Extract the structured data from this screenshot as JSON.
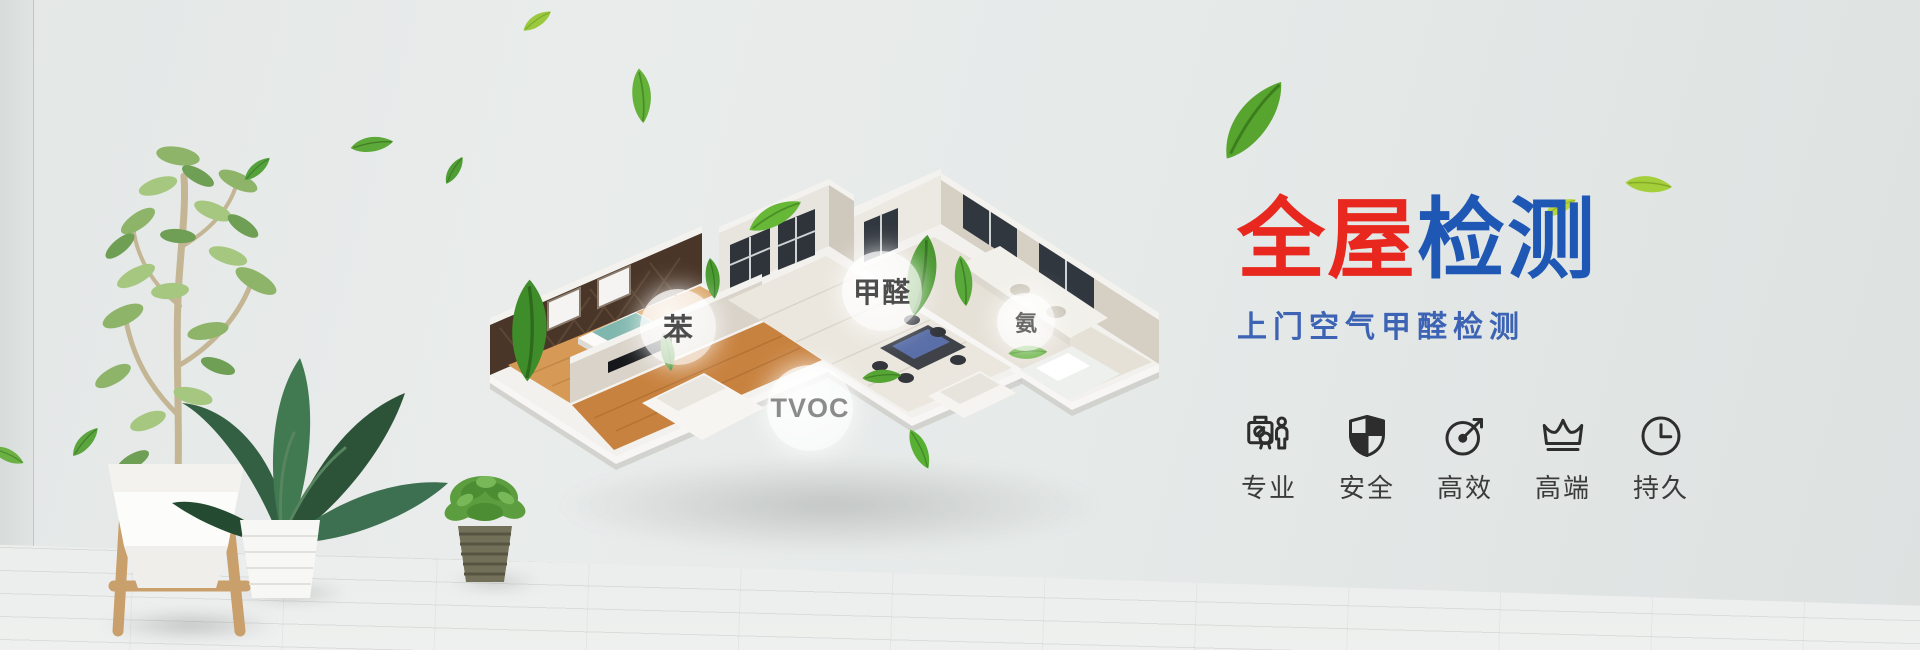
{
  "hero": {
    "title": {
      "part1": "全屋",
      "part2": "检测",
      "part1_color": "#e8281f",
      "part2_color": "#1f57b5"
    },
    "subtitle": {
      "text": "上门空气甲醛检测",
      "color": "#3c63b4"
    },
    "features": [
      {
        "icon": "certificate-person-icon",
        "label": "专业"
      },
      {
        "icon": "shield-icon",
        "label": "安全"
      },
      {
        "icon": "gauge-arrow-icon",
        "label": "高效"
      },
      {
        "icon": "crown-icon",
        "label": "高端"
      },
      {
        "icon": "clock-icon",
        "label": "持久"
      }
    ],
    "bubbles": [
      {
        "label": "苯"
      },
      {
        "label": "甲醛"
      },
      {
        "label": "氨"
      },
      {
        "label": "TVOC"
      }
    ]
  },
  "scene": {
    "wall_color": "#e6eae9",
    "floor_color": "#e7e9e8",
    "leaf_green": "#57a52e",
    "lime_green": "#a5cf3a",
    "house_wood": "#d79a56",
    "house_wall": "#d9d3c9",
    "accent_wall_brown": "#4a3628"
  }
}
